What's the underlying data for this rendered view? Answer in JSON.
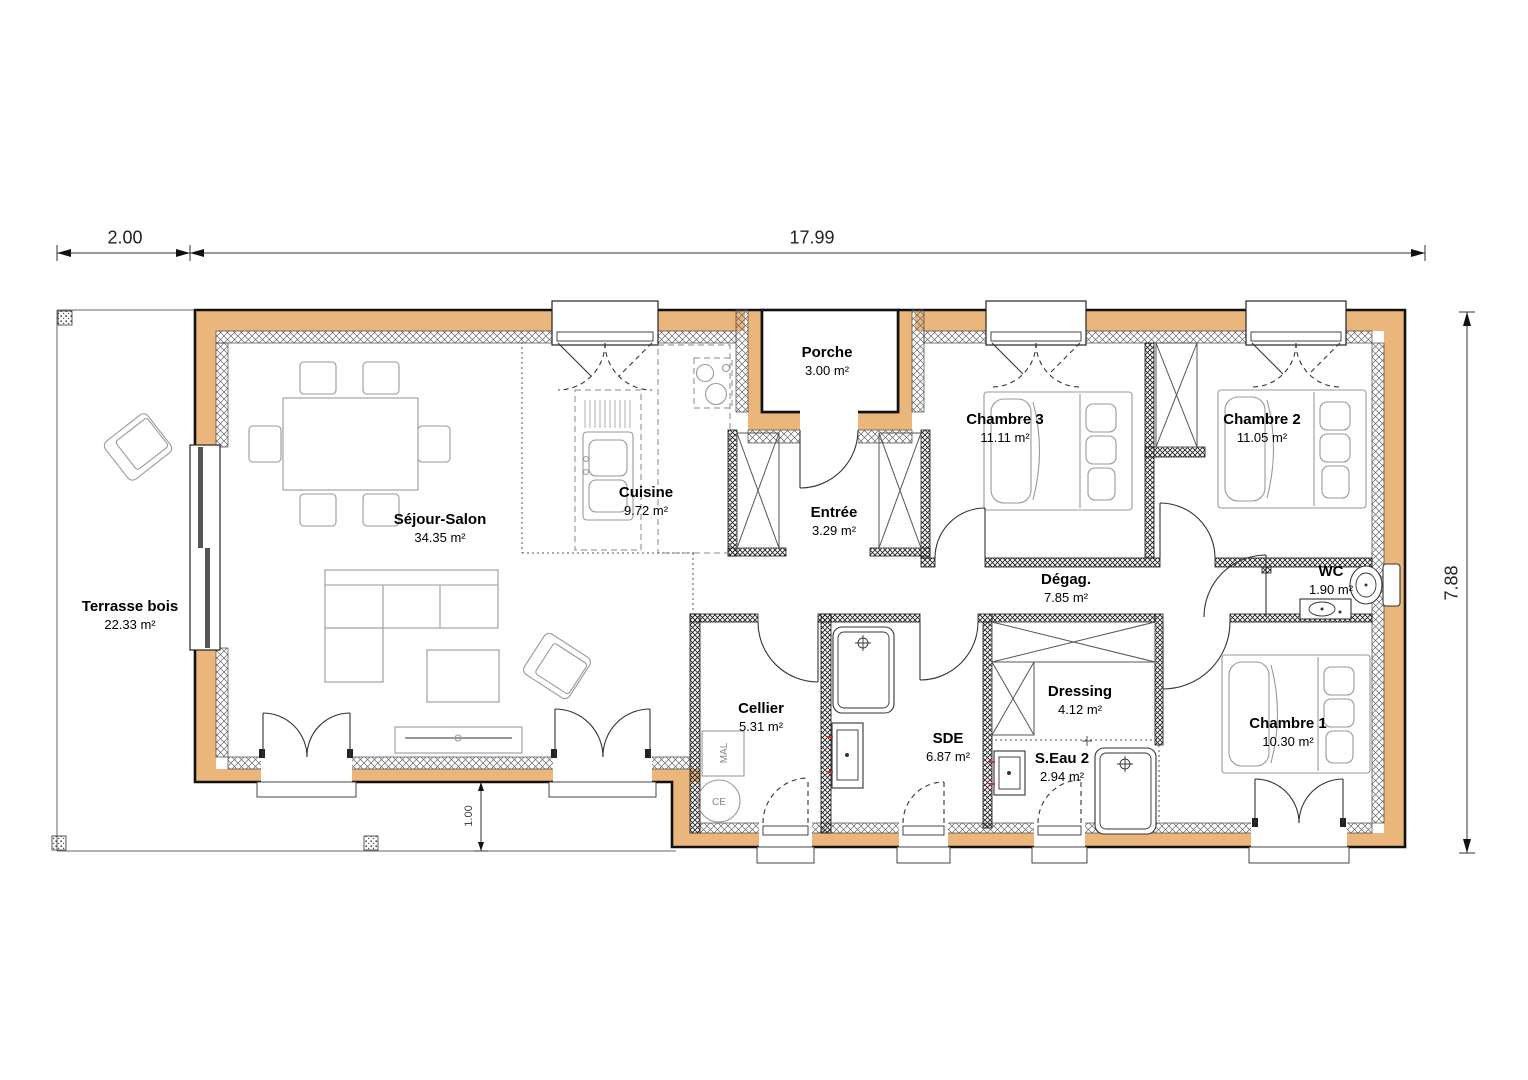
{
  "plan": {
    "rooms": [
      {
        "name": "Terrasse bois",
        "area": "22.33 m²"
      },
      {
        "name": "Séjour-Salon",
        "area": "34.35 m²"
      },
      {
        "name": "Cuisine",
        "area": "9.72 m²"
      },
      {
        "name": "Porche",
        "area": "3.00 m²"
      },
      {
        "name": "Entrée",
        "area": "3.29 m²"
      },
      {
        "name": "Chambre 3",
        "area": "11.11 m²"
      },
      {
        "name": "Chambre 2",
        "area": "11.05 m²"
      },
      {
        "name": "Dégag.",
        "area": "7.85 m²"
      },
      {
        "name": "WC",
        "area": "1.90 m²"
      },
      {
        "name": "Cellier",
        "area": "5.31 m²"
      },
      {
        "name": "SDE",
        "area": "6.87 m²"
      },
      {
        "name": "Dressing",
        "area": "4.12 m²"
      },
      {
        "name": "S.Eau 2",
        "area": "2.94 m²"
      },
      {
        "name": "Chambre 1",
        "area": "10.30 m²"
      }
    ],
    "dimensions": {
      "terrace_width": "2.00",
      "house_width": "17.99",
      "house_height": "7.88",
      "terrace_depth": "1.00"
    },
    "equipment": {
      "washing_machine": "MAL",
      "water_heater": "CE"
    },
    "colors": {
      "wall": "#EBB67C",
      "outline": "#111111",
      "furniture": "#999999"
    }
  }
}
